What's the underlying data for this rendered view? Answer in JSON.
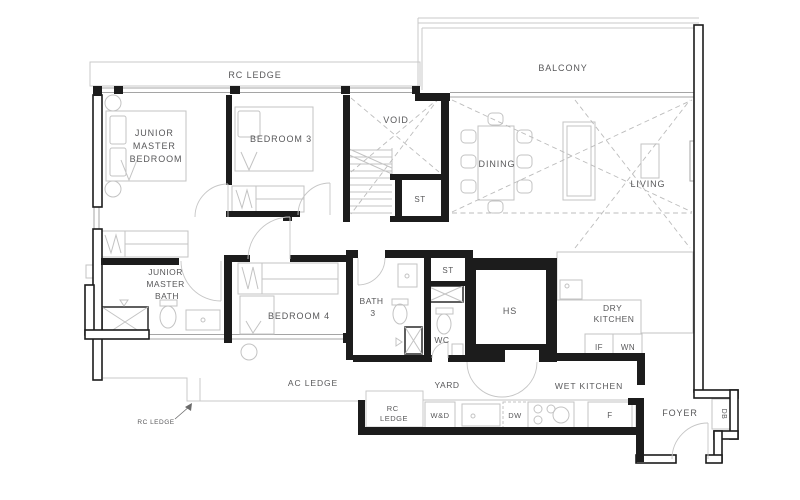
{
  "plan": {
    "type": "residential-unit-floor-plan",
    "colors": {
      "wall": "#1c1c1c",
      "furniture_line": "#c3c3c3",
      "window_line": "#a5a5a5",
      "dashed_line": "#bcbcbc",
      "label_text": "#58585a",
      "background": "#ffffff"
    },
    "labels": {
      "rc_ledge_top": "RC LEDGE",
      "balcony": "BALCONY",
      "void": "VOID",
      "st_void": "ST",
      "dining": "DINING",
      "living": "LIVING",
      "junior_master_bedroom": [
        "JUNIOR",
        "MASTER",
        "BEDROOM"
      ],
      "bedroom_3": "BEDROOM 3",
      "bedroom_4": "BEDROOM 4",
      "junior_master_bath": [
        "JUNIOR",
        "MASTER",
        "BATH"
      ],
      "bath_3": [
        "BATH",
        "3"
      ],
      "st_hall": "ST",
      "wc": "WC",
      "hs": "HS",
      "dry_kitchen": [
        "DRY",
        "KITCHEN"
      ],
      "if_appliance": "IF",
      "wn_appliance": "WN",
      "ac_ledge": "AC LEDGE",
      "yard": "YARD",
      "wet_kitchen": "WET KITCHEN",
      "rc_ledge_lower": [
        "RC",
        "LEDGE"
      ],
      "rc_ledge_callout": "RC LEDGE",
      "washer_dryer": "W&D",
      "dishwasher": "DW",
      "fridge": "F",
      "foyer": "FOYER",
      "db": "DB"
    }
  }
}
